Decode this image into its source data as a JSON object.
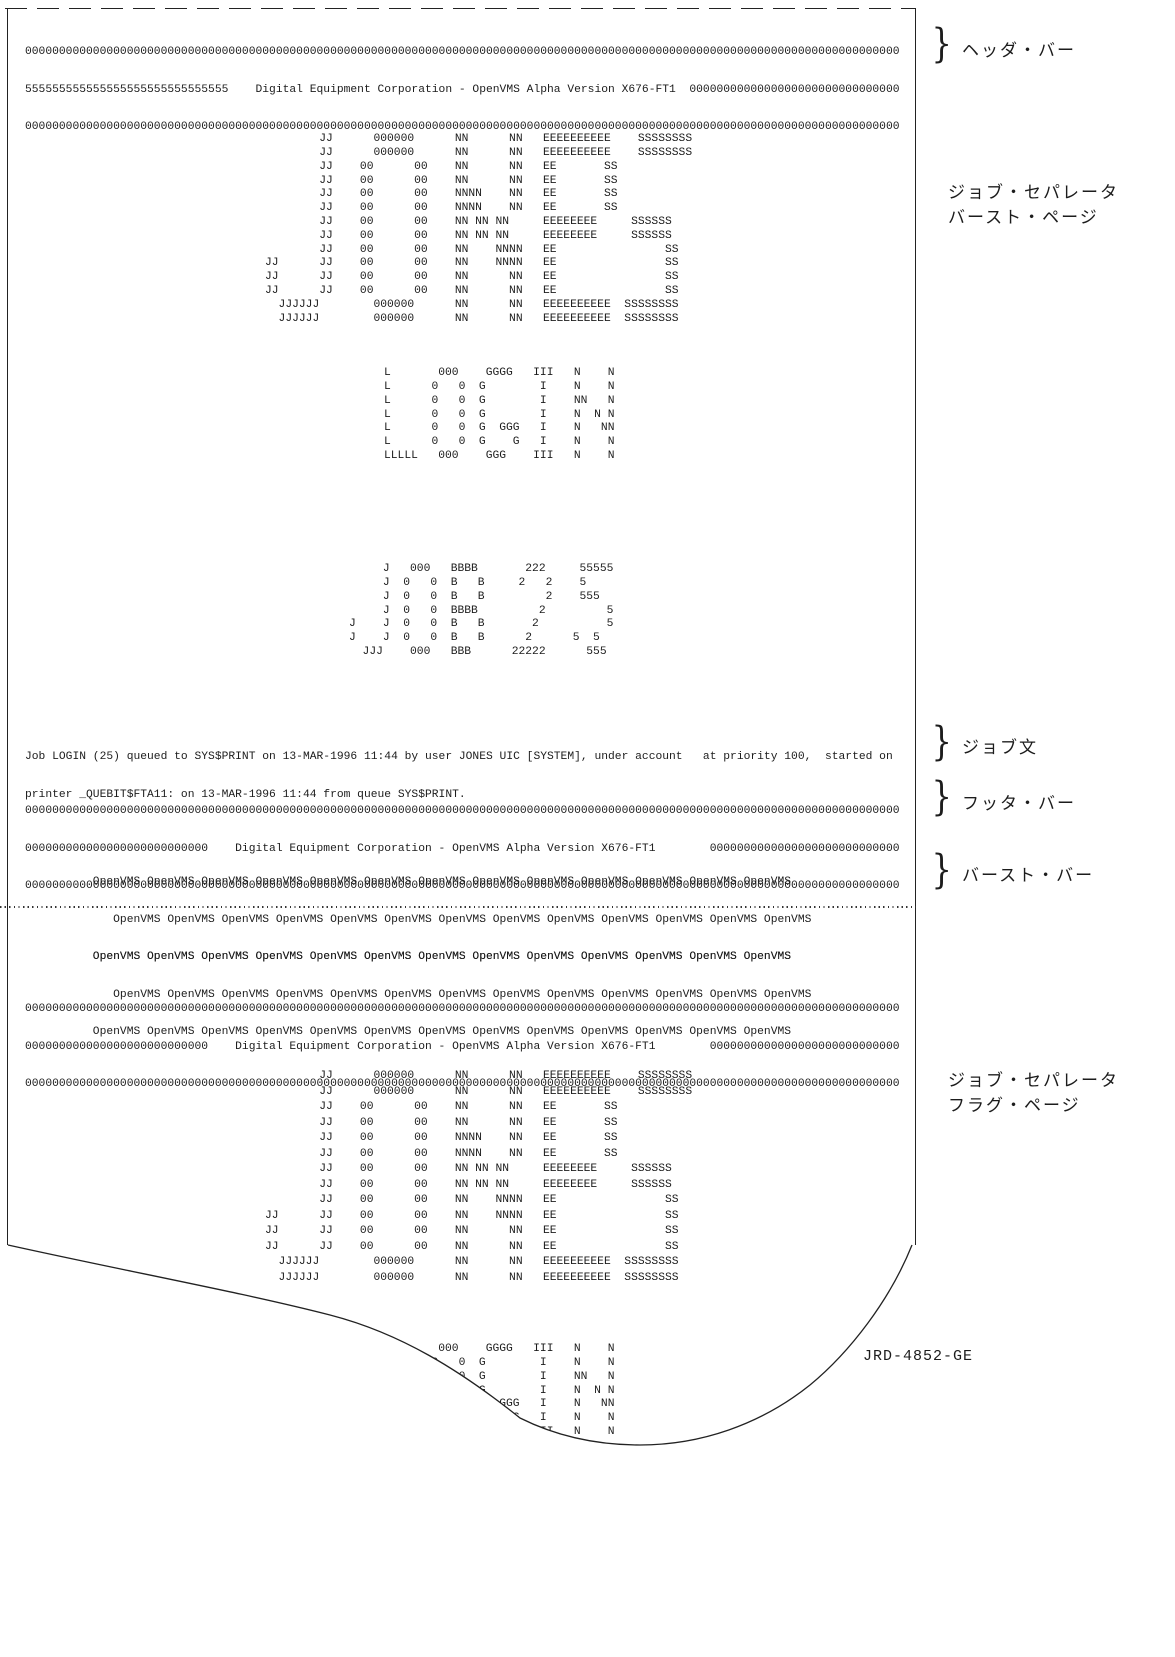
{
  "bars": {
    "zeros": "000000000000000000000000000000000000000000000000000000000000000000000000000000000000000000000000000000000000000000000000000000000",
    "header_mid": "555555555555555555555555555555    Digital Equipment Corporation - OpenVMS Alpha Version X676-FT1  0000000000000000000000000000000",
    "footer_mid": "000000000000000000000000000    Digital Equipment Corporation - OpenVMS Alpha Version X676-FT1        0000000000000000000000000000"
  },
  "banners": {
    "jones": [
      "        JJ      000000      NN      NN   EEEEEEEEEE    SSSSSSSS",
      "        JJ      000000      NN      NN   EEEEEEEEEE    SSSSSSSS",
      "        JJ    00      00    NN      NN   EE       SS",
      "        JJ    00      00    NN      NN   EE       SS",
      "        JJ    00      00    NNNN    NN   EE       SS",
      "        JJ    00      00    NNNN    NN   EE       SS",
      "        JJ    00      00    NN NN NN     EEEEEEEE     SSSSSS",
      "        JJ    00      00    NN NN NN     EEEEEEEE     SSSSSS",
      "        JJ    00      00    NN    NNNN   EE                SS",
      "JJ      JJ    00      00    NN    NNNN   EE                SS",
      "JJ      JJ    00      00    NN      NN   EE                SS",
      "JJ      JJ    00      00    NN      NN   EE                SS",
      "  JJJJJJ        000000      NN      NN   EEEEEEEEEE  SSSSSSSS",
      "  JJJJJJ        000000      NN      NN   EEEEEEEEEE  SSSSSSSS"
    ],
    "login": [
      "L       000    GGGG   III   N    N",
      "L      0   0  G        I    N    N",
      "L      0   0  G        I    NN   N",
      "L      0   0  G        I    N  N N",
      "L      0   0  G  GGG   I    N   NN",
      "L      0   0  G    G   I    N    N",
      "LLLLL   000    GGG    III   N    N"
    ],
    "job25": [
      "     J   000   BBBB       222     55555",
      "     J  0   0  B   B     2   2    5",
      "     J  0   0  B   B         2    555",
      "     J  0   0  BBBB         2         5",
      "J    J  0   0  B   B       2          5",
      "J    J  0   0  B   B      2      5  5",
      "  JJJ    000   BBB      22222      555"
    ]
  },
  "job_text": {
    "line1": "Job LOGIN (25) queued to SYS$PRINT on 13-MAR-1996 11:44 by user JONES UIC [SYSTEM], under account   at priority 100,  started on",
    "line2": "printer _QUEBIT$FTA11: on 13-MAR-1996 11:44 from queue SYS$PRINT."
  },
  "openvms_pattern": {
    "row1": "          OpenVMS OpenVMS OpenVMS OpenVMS OpenVMS OpenVMS OpenVMS OpenVMS OpenVMS OpenVMS OpenVMS OpenVMS OpenVMS",
    "row2": "             OpenVMS OpenVMS OpenVMS OpenVMS OpenVMS OpenVMS OpenVMS OpenVMS OpenVMS OpenVMS OpenVMS OpenVMS OpenVMS",
    "row3": "          OpenVMS OpenVMS OpenVMS OpenVMS OpenVMS OpenVMS OpenVMS OpenVMS OpenVMS OpenVMS OpenVMS OpenVMS OpenVMS"
  },
  "annotations": {
    "brace": "}",
    "header_bar": "ヘッダ・バー",
    "separator_burst_line1": "ジョブ・セパレータ",
    "separator_burst_line2": "バースト・ページ",
    "job_text": "ジョブ文",
    "footer_bar": "フッタ・バー",
    "burst_bar": "バースト・バー",
    "separator_flag_line1": "ジョブ・セパレータ",
    "separator_flag_line2": "フラグ・ページ"
  },
  "figure_label": "JRD-4852-GE",
  "colors": {
    "ink": "#1c1c1c",
    "paper": "#ffffff"
  }
}
